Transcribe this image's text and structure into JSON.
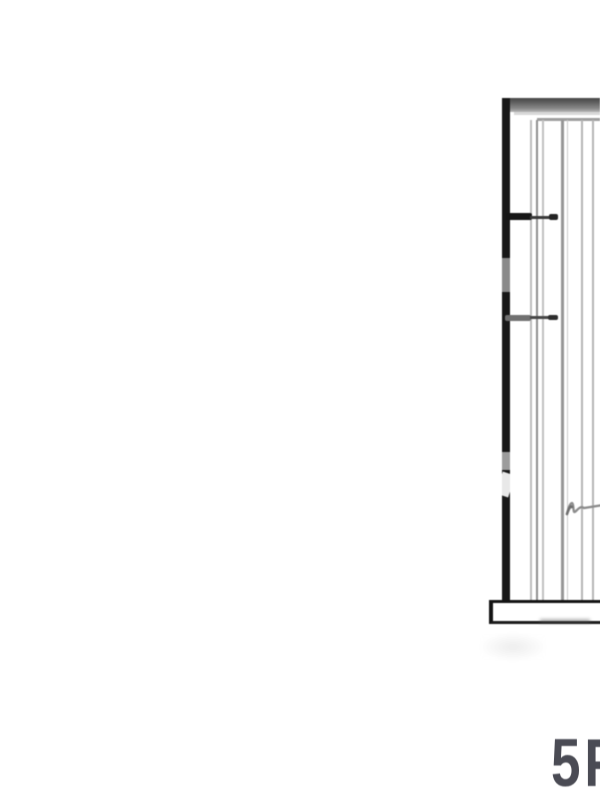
{
  "page": {
    "background": "#ffffff"
  },
  "drawing": {
    "label": "5F",
    "label_color": "#4a4b54",
    "ink_color": "#161616",
    "header_gray": "#6e6e6e",
    "panel_line_color": "#9a9a9a",
    "squiggle_color": "#8c8c8c"
  }
}
